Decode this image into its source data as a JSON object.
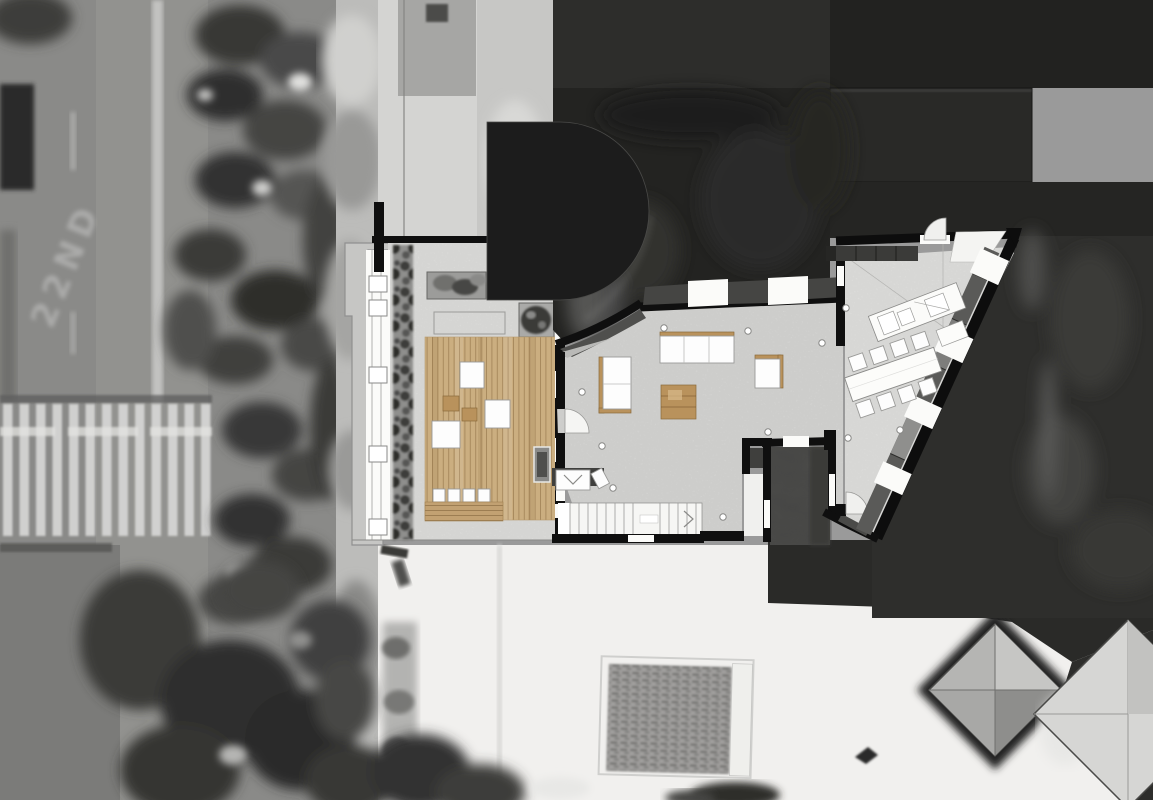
{
  "meta": {
    "description": "Architectural floor plan of a rooftop apartment collaged over a grayscale aerial photograph",
    "image_type": "site-plan-collage",
    "text_content": "none (drawing only, except faint painted road marking)"
  },
  "background": {
    "road_marking_text": "22ND",
    "features": [
      "asphalt-street",
      "lane-divider-line",
      "pedestrian-crosswalk",
      "stop-line",
      "parked-vehicle-shadow",
      "street-tree-row",
      "sidewalk",
      "neighboring-dark-flat-roofs",
      "semicircular-drum-roof",
      "dark-textured-roof",
      "white-roof-terrace",
      "clay-tile-roof-patch",
      "hipped-pyramid-roof",
      "partial-hipped-roof",
      "south-tree-cluster",
      "cast-shadow-areas"
    ]
  },
  "plan": {
    "rooms": [
      {
        "id": "deck-terrace",
        "label": "Timber deck terrace",
        "floor": "wood"
      },
      {
        "id": "living-room",
        "label": "Living room",
        "floor": "concrete"
      },
      {
        "id": "dining-kitchen",
        "label": "Dining / kitchen",
        "floor": "concrete"
      },
      {
        "id": "courtyard-void",
        "label": "Courtyard void",
        "floor": "open-to-below"
      },
      {
        "id": "stair-hall",
        "label": "Staircase",
        "floor": "stairs"
      }
    ],
    "furniture": [
      "planter-box",
      "tree-planter",
      "lounge-table",
      "side-table",
      "fire-pit",
      "bar-bench",
      "bar-stool",
      "three-seat-sofa",
      "two-seat-sofa",
      "coffee-table",
      "armchair",
      "dining-table",
      "dining-chair",
      "kitchen-counter",
      "wall-cabinets",
      "entry-door",
      "terrace-door",
      "balcony-door"
    ],
    "counts": {
      "bar_stools": 4,
      "dining_chairs_top": 4,
      "dining_chairs_bottom": 4,
      "stair_treads": 13
    }
  },
  "palette": {
    "road": "#8a8a88",
    "road_lower": "#7b7b79",
    "sidewalk": "#bcbcba",
    "white_roof": "#f1f0ee",
    "dark_roof": "#2d2d2b",
    "dark_roof_texture": "#232321",
    "dark_roof_b": "#292927",
    "drum": "#1c1c1c",
    "shadow_right": "#2e2e2c",
    "shadow_bottom": "#2a2a28",
    "wood": "#cbae80",
    "wood_dark": "#b9925c",
    "concrete_deck": "#e4e4e2",
    "concrete_living": "#dededc",
    "concrete_dining": "#e6e6e4",
    "wall": "#0f0f0f",
    "gray_band": "#c6c6c4",
    "courtyard": "#4a4a48",
    "cabinet": "#3b3b39",
    "plant_strip": "#7c7c7a"
  }
}
